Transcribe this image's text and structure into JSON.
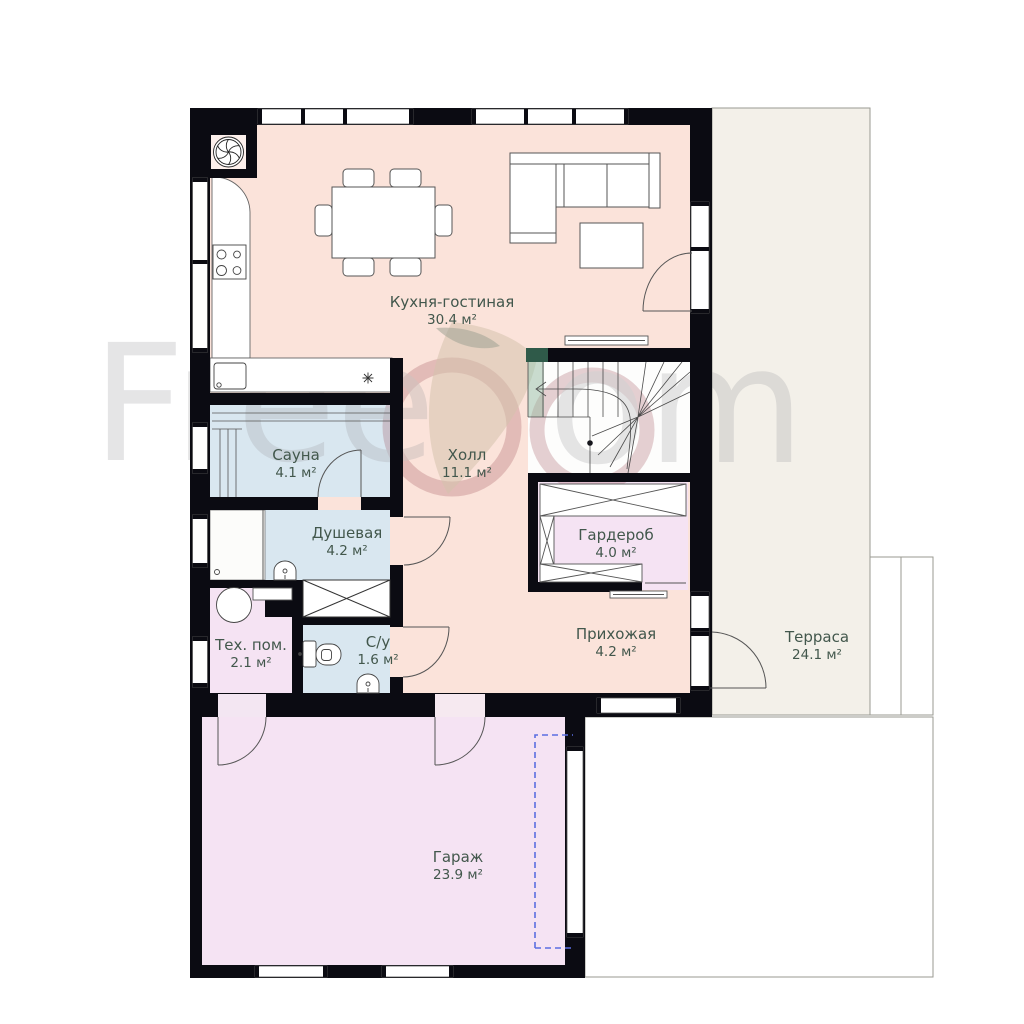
{
  "watermark": {
    "part1": "Free",
    "part2": "om"
  },
  "palette": {
    "room_pink": "#fbe3da",
    "wet_blue": "#d9e7f0",
    "aux_lavender": "#f5e3f3",
    "terrace_beige": "#f3f0e9",
    "wall": "#0b0b12",
    "garage_door_dash": "#5b6ee1",
    "label_text": "#42574c"
  },
  "rooms": {
    "kitchen": {
      "name": "Кухня-гостиная",
      "area": "30.4 м²"
    },
    "sauna": {
      "name": "Сауна",
      "area": "4.1 м²"
    },
    "shower": {
      "name": "Душевая",
      "area": "4.2 м²"
    },
    "hall": {
      "name": "Холл",
      "area": "11.1 м²"
    },
    "wardrobe": {
      "name": "Гардероб",
      "area": "4.0 м²"
    },
    "tech": {
      "name": "Тех. пом.",
      "area": "2.1 м²"
    },
    "wc": {
      "name": "С/у",
      "area": "1.6 м²"
    },
    "hallway": {
      "name": "Прихожая",
      "area": "4.2 м²"
    },
    "garage": {
      "name": "Гараж",
      "area": "23.9 м²"
    },
    "terrace": {
      "name": "Терраса",
      "area": "24.1 м²"
    }
  }
}
